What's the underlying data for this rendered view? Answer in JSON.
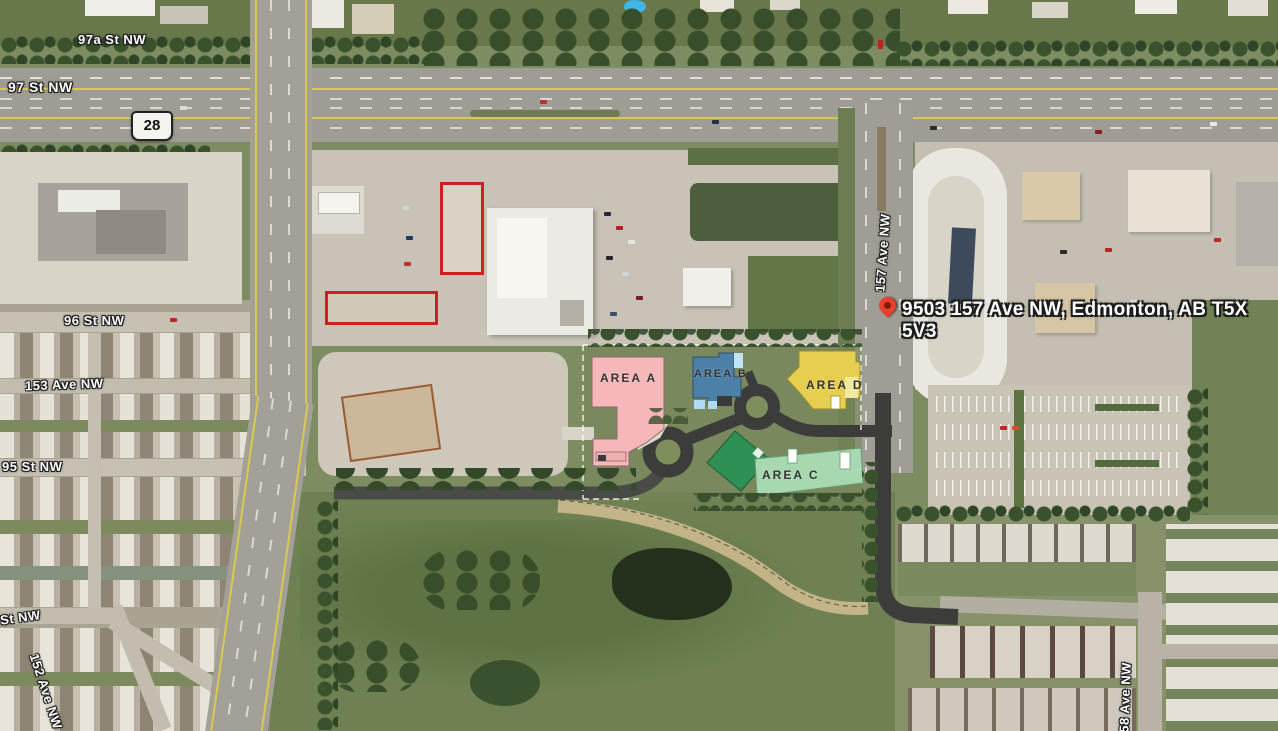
{
  "map": {
    "title": "Aerial site map - 9503 157 Ave NW, Edmonton",
    "address_marker": {
      "label": "9503 157 Ave NW, Edmonton, AB T5X 5V3",
      "pin_color": "#e8402a"
    },
    "highway_shield": "28",
    "street_labels": {
      "st_97a": "97a St NW",
      "st_97": "97 St NW",
      "st_96": "96 St NW",
      "st_95": "95 St NW",
      "st_partial": "St NW",
      "ave_153": "153 Ave NW",
      "ave_152": "152 Ave NW",
      "ave_157": "157 Ave NW",
      "ave_158": "158 Ave NW"
    },
    "site_plan": {
      "areas": [
        {
          "label": "AREA A",
          "color": "#f6b7bb"
        },
        {
          "label": "AREA B",
          "color": "#4d80a8"
        },
        {
          "label": "AREA C",
          "color": "#2f9055",
          "secondary_color": "#a8d8b0"
        },
        {
          "label": "AREA D",
          "color": "#e6cf4e"
        }
      ],
      "road_color": "#3c3c3a"
    }
  }
}
